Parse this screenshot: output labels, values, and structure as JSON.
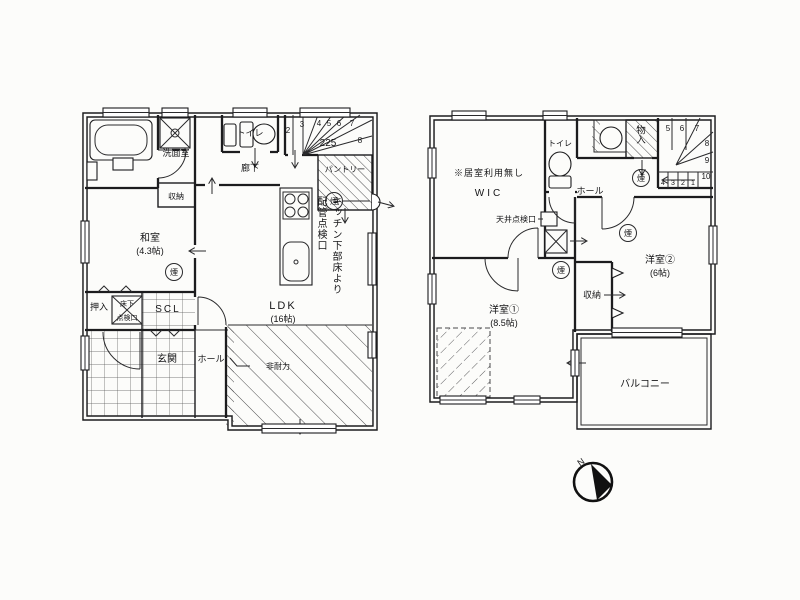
{
  "palette": {
    "ink": "#1c1c1e",
    "paper": "#fcfcfa"
  },
  "smoke_label": "煙",
  "compass": {
    "north": "N"
  },
  "floor1": {
    "washroom": "洗面室",
    "toilet": "トイレ",
    "corridor": "廊下",
    "pantry": "パントリー",
    "closet": "収納",
    "washitsu": "和室",
    "washitsu_size": "(4.3帖)",
    "oshiire": "押入",
    "underfloor_hatch_line1": "床下",
    "underfloor_hatch_line2": "点検口",
    "scl": "SCL",
    "genkan": "玄関",
    "hall": "ホール",
    "ldk": "LDK",
    "ldk_size": "(16帖)",
    "kitchen_note_line1": "キッチン下部床より",
    "kitchen_note_line2": "配管点検口",
    "non_bearing": "非耐力",
    "stair_rise": "225",
    "stair_nums": [
      "2",
      "3",
      "4",
      "5",
      "6",
      "7",
      "8"
    ]
  },
  "floor2": {
    "no_living_note": "※居室利用無し",
    "wic": "WIC",
    "toilet": "トイレ",
    "hall": "ホール",
    "monoire": "物入",
    "ceiling_hatch": "天井点検口",
    "closet": "収納",
    "room2": "洋室②",
    "room2_size": "(6帖)",
    "room1": "洋室①",
    "room1_size": "(8.5帖)",
    "balcony": "バルコニー",
    "stair_nums_top": [
      "5",
      "6",
      "7"
    ],
    "stair_nums_right": [
      "8",
      "9",
      "10"
    ],
    "stair_nums_bottom": [
      "4",
      "3",
      "2",
      "1"
    ]
  }
}
